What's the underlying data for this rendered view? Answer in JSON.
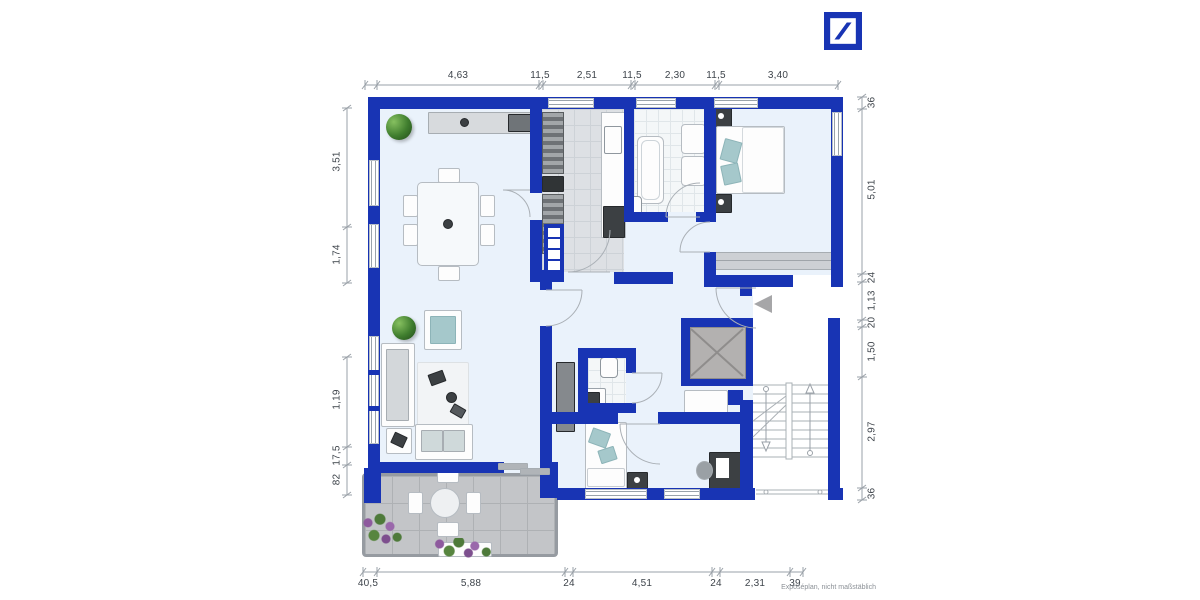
{
  "branding": {
    "logo": "Deutsche Bank"
  },
  "footnote": "Exposéplan, nicht maßstäblich",
  "dimensions": {
    "top": [
      "4,63",
      "11,5",
      "2,51",
      "11,5",
      "2,30",
      "11,5",
      "3,40"
    ],
    "left": [
      "3,51",
      "1,74",
      "1,19",
      "17,5",
      "82"
    ],
    "right": [
      "36",
      "5,01",
      "24",
      "1,13",
      "20",
      "1,50",
      "2,97",
      "36"
    ],
    "bottom": [
      "40,5",
      "5,88",
      "24",
      "4,51",
      "24",
      "2,31",
      "39"
    ]
  },
  "colors": {
    "wall_blue": "#1834b4",
    "floor": "#eaf2fb",
    "terrace_gray": "#c3c5c8",
    "accent_teal": "#a5c8cb",
    "dimension_gray": "#9aa1a8"
  }
}
